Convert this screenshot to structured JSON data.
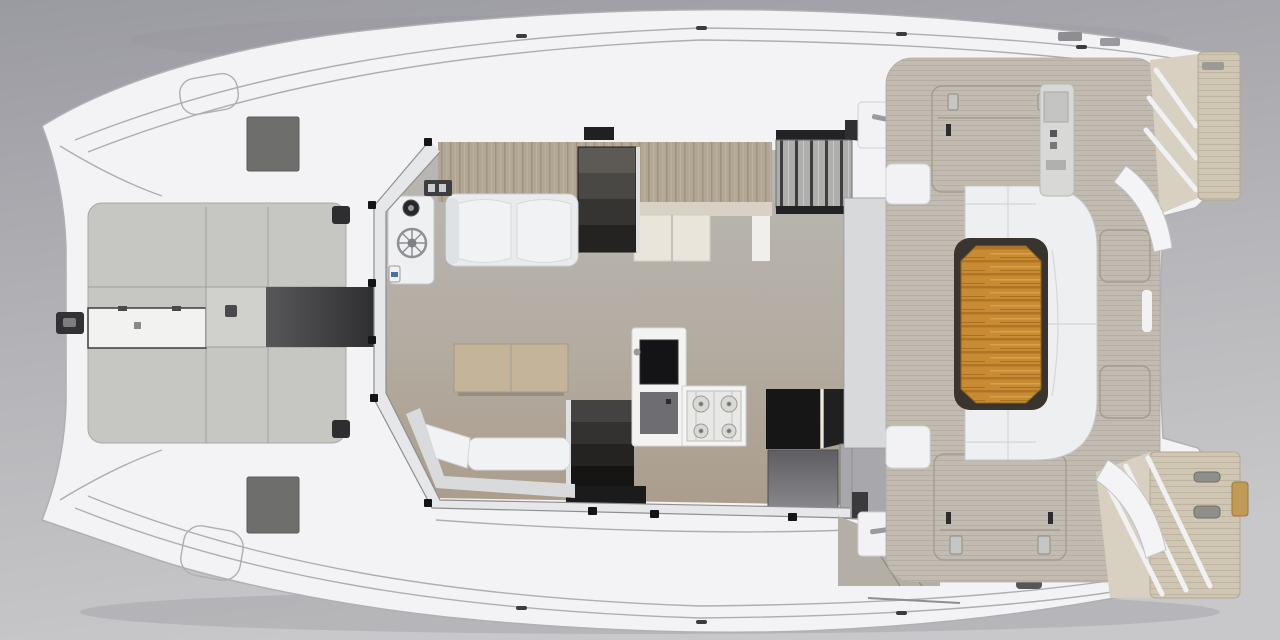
{
  "image": {
    "type": "3d-render-top-view",
    "subject": "catamaran-deck-and-interior-floor-plan"
  },
  "palette": {
    "bg_top": "#9a9aa1",
    "bg_bottom": "#c8c8ca",
    "boat_shadow": "#8f8f94",
    "hull_white": "#f3f3f5",
    "hull_outline": "#b0b0b4",
    "foredeck_gray": "#c6c7c3",
    "foredeck_square": "#d0d1cd",
    "locker_white": "#f2f2f0",
    "hatch_dark": "#6e6e6c",
    "fitting_dark": "#2e2e30",
    "windlass_dark": "#323234",
    "frame_band": "#e6e7e9",
    "wood_cream_band": "#d8d2c6",
    "cabinet_cream": "#e9e5da",
    "sofa_white": "#f1f2f4",
    "sofa_base": "#e9ebed",
    "armrest": "#dfe2e5",
    "helm_console": "#eff0f2",
    "instrument_dark": "#28282a",
    "gauge_blue": "#4a6fa5",
    "table_wood": "#c4b49a",
    "bench_back": "#d9dadc",
    "mat_black": "#1b1b1b",
    "island_white": "#f3f3f1",
    "sink_black": "#141416",
    "island_gray": "#6e6e72",
    "stove_white": "#f4f4f2",
    "stove_grate": "#e8e8e6",
    "counter_black": "#161616",
    "door_gray": "#a8a8ac",
    "divider_gray": "#d8d9db",
    "roof_hatch_dark": "#202022",
    "roof_wedge_dark": "#2f2f31",
    "slat_strip_dark": "#232325",
    "module_white": "#f2f2f4",
    "side_band": "#cac5bc",
    "aft_wedge_gray": "#b3afa7",
    "settee_white": "#edeff0",
    "table_shadow": "#39352e",
    "helm_panel": "#d8d8d6",
    "davit_white": "#f4f4f6",
    "step_face": "#d8d1c2",
    "gold_block": "#c19a55",
    "cleat_gray": "#8e8e8a",
    "teak_base": "#c88b33",
    "teak_dark": "#b07524",
    "teak_light": "#d9a048",
    "cockpit_deck_base": "#c2bbb1",
    "platform_base": "#cfc6b4"
  }
}
